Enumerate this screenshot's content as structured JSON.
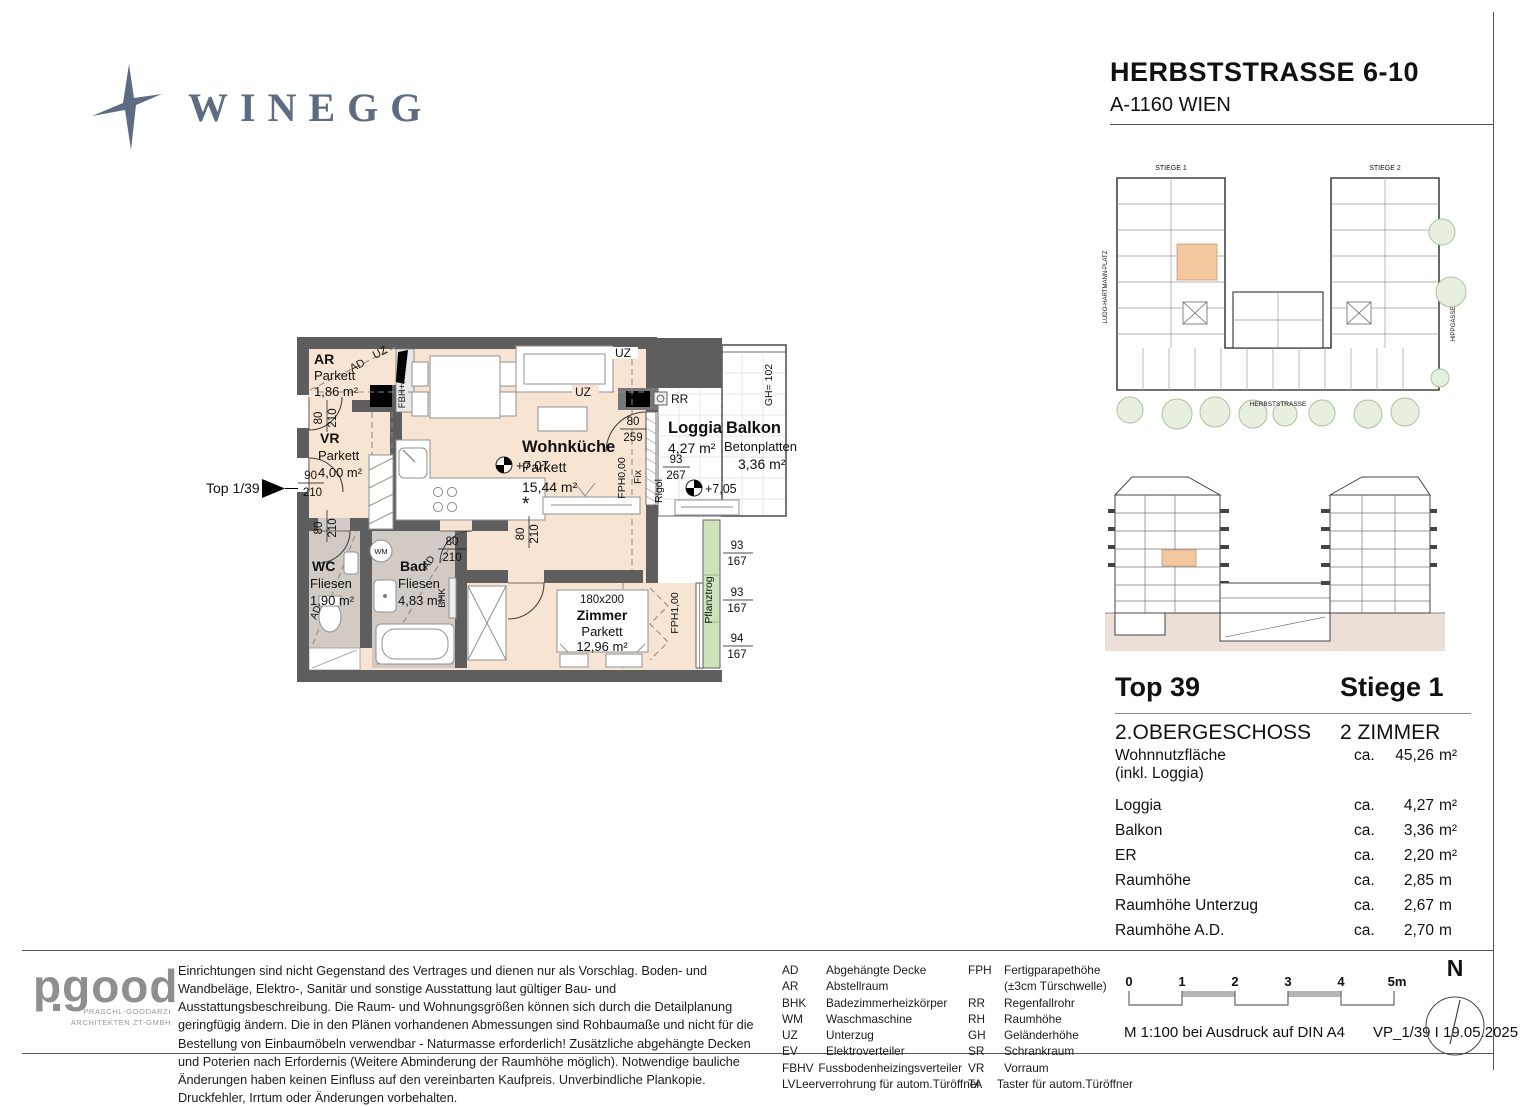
{
  "header": {
    "company": "WINEGG",
    "title": "HERBSTSTRASSE 6-10",
    "address": "A-1160 WIEN"
  },
  "plan": {
    "marker": "Top 1/39",
    "rooms": {
      "ar": {
        "name": "AR",
        "finish": "Parkett",
        "area": "1,86 m²"
      },
      "vr": {
        "name": "VR",
        "finish": "Parkett",
        "area": "4,00 m²"
      },
      "wc": {
        "name": "WC",
        "finish": "Fliesen",
        "area": "1,90 m²"
      },
      "bad": {
        "name": "Bad",
        "finish": "Fliesen",
        "area": "4,83 m²"
      },
      "wohnkueche": {
        "name": "Wohnküche",
        "finish": "Parkett",
        "area": "15,44 m²"
      },
      "zimmer": {
        "name": "Zimmer",
        "finish": "Parkett",
        "area": "12,96 m²"
      },
      "loggia": {
        "name": "Loggia",
        "area": "4,27 m²"
      },
      "balkon": {
        "name": "Balkon",
        "finish": "Betonplatten",
        "area": "3,36 m²"
      }
    },
    "ann": {
      "uz": "UZ",
      "ad": "AD",
      "rr": "RR",
      "wm": "WM",
      "bhk": "BHK",
      "fbh": "FBH+IT+E-V",
      "fph0": "FPH0,00",
      "fph1": "FPH1,00",
      "fix": "Fix",
      "rigol": "Rigol",
      "gh": "GH= 102",
      "pflanztrog": "Pflanztrog",
      "level_main": "+7,07",
      "level_balcony": "+7,05",
      "bed_size": "180x200",
      "appliance": "*"
    },
    "dims": {
      "d80": "80",
      "d90": "90",
      "d93": "93",
      "d94": "94",
      "d167": "167",
      "d210": "210",
      "d259": "259",
      "d267": "267"
    }
  },
  "site_plan": {
    "stiege1": "STIEGE 1",
    "stiege2": "STIEGE 2",
    "street_left": "LUDO-HARTMANN-PLATZ",
    "street_bottom": "HERBSTSTRASSE",
    "street_right": "HIPPGASSE"
  },
  "details": {
    "top": "Top 39",
    "stiege": "Stiege 1",
    "floor": "2.OBERGESCHOSS",
    "type": "2 ZIMMER",
    "rows": [
      {
        "label": "Wohnnutzfläche",
        "label2": "(inkl. Loggia)",
        "ca": "ca.",
        "value": "45,26",
        "unit": "m²"
      },
      {
        "label": "Loggia",
        "ca": "ca.",
        "value": "4,27",
        "unit": "m²"
      },
      {
        "label": "Balkon",
        "ca": "ca.",
        "value": "3,36",
        "unit": "m²"
      },
      {
        "label": "ER",
        "ca": "ca.",
        "value": "2,20",
        "unit": "m²"
      },
      {
        "label": "Raumhöhe",
        "ca": "ca.",
        "value": "2,85",
        "unit": "m"
      },
      {
        "label": "Raumhöhe Unterzug",
        "ca": "ca.",
        "value": "2,67",
        "unit": "m"
      },
      {
        "label": "Raumhöhe A.D.",
        "ca": "ca.",
        "value": "2,70",
        "unit": "m"
      }
    ]
  },
  "footer": {
    "architect": {
      "name": "pgood",
      "line1": "PRASCHL-GOODARZI",
      "line2": "ARCHITEKTEN ZT-GMBH"
    },
    "disclaimer": "Einrichtungen sind nicht Gegenstand des Vertrages und dienen nur als Vorschlag. Boden- und Wandbeläge, Elektro-, Sanitär und sonstige Ausstattung laut gültiger Bau- und Ausstattungsbeschreibung. Die Raum- und Wohnungsgrößen können sich durch die Detailplanung geringfügig ändern. Die in den Plänen vorhandenen Abmessungen sind Rohbaumaße und nicht für die Bestellung von Einbaumöbeln verwendbar - Naturmasse erforderlich! Zusätzliche abgehängte Decken und Poterien nach Erfordernis (Weitere Abminderung der Raumhöhe möglich). Notwendige bauliche Änderungen haben keinen Einfluss auf den vereinbarten Kaufpreis. Unverbindliche Plankopie. Druckfehler, Irrtum oder Änderungen vorbehalten.",
    "legend_col1": [
      {
        "abbr": "AD",
        "text": "Abgehängte Decke"
      },
      {
        "abbr": "AR",
        "text": "Abstellraum"
      },
      {
        "abbr": "BHK",
        "text": "Badezimmerheizkörper"
      },
      {
        "abbr": "WM",
        "text": "Waschmaschine"
      },
      {
        "abbr": "UZ",
        "text": "Unterzug"
      },
      {
        "abbr": "EV",
        "text": "Elektroverteiler"
      },
      {
        "abbr": "FBHV",
        "text": "Fussbodenheizingsverteiler"
      },
      {
        "abbr": "LV",
        "text": "Leerverrohrung für autom.Türöffner"
      }
    ],
    "legend_col2": [
      {
        "abbr": "FPH",
        "text": "Fertigparapethöhe"
      },
      {
        "abbr": "",
        "text": "(±3cm Türschwelle)"
      },
      {
        "abbr": "RR",
        "text": "Regenfallrohr"
      },
      {
        "abbr": "RH",
        "text": "Raumhöhe"
      },
      {
        "abbr": "GH",
        "text": "Geländerhöhe"
      },
      {
        "abbr": "SR",
        "text": "Schrankraum"
      },
      {
        "abbr": "VR",
        "text": "Vorraum"
      },
      {
        "abbr": "TA",
        "text": "Taster für autom.Türöffner"
      }
    ],
    "scale": {
      "ticks": [
        "0",
        "1",
        "2",
        "3",
        "4",
        "5m"
      ],
      "note": "M 1:100 bei Ausdruck auf DIN A4",
      "version": "VP_1/39 I 19.05.2025"
    },
    "north": "N"
  }
}
